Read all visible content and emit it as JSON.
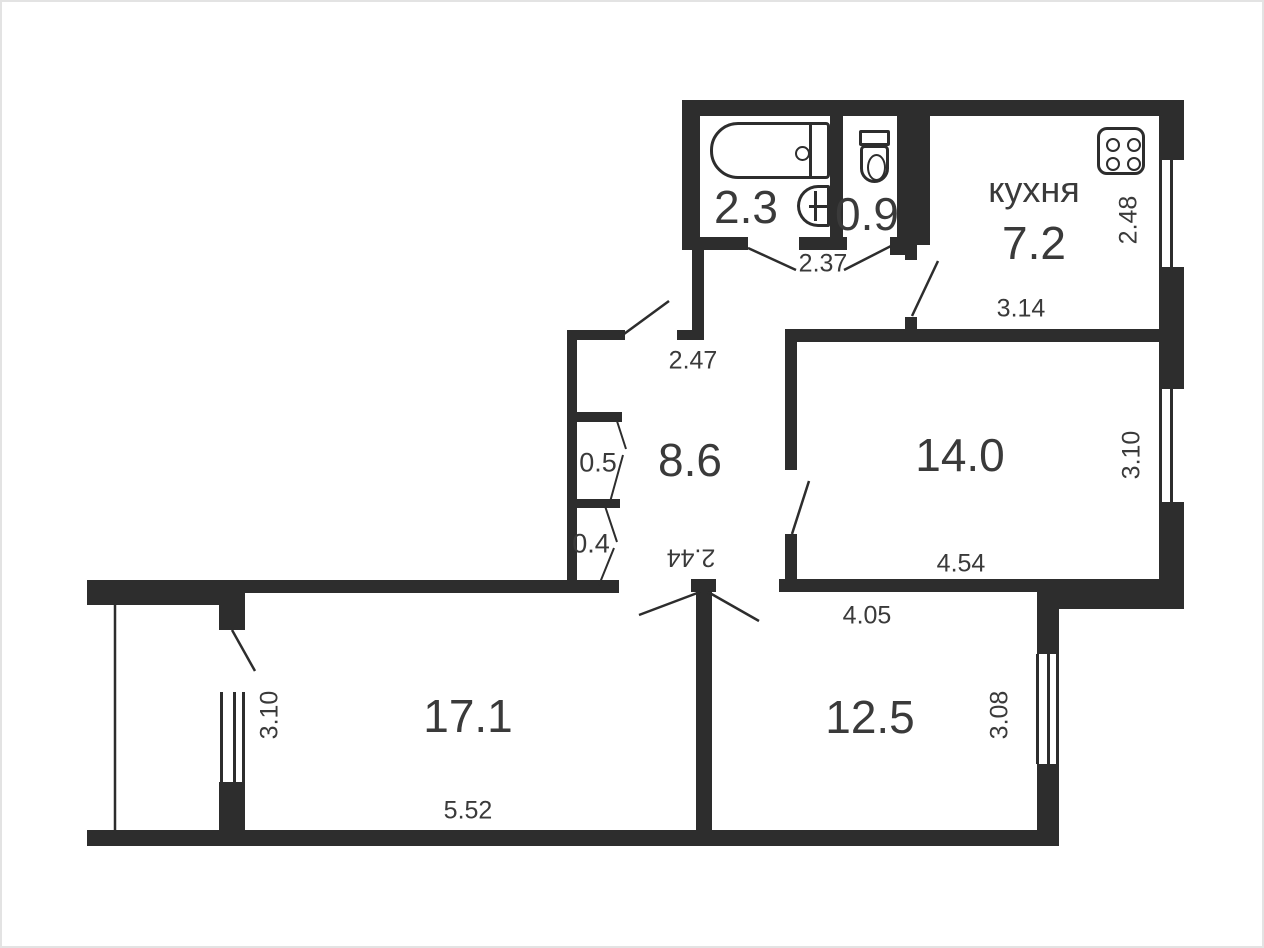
{
  "title": "apartment-floor-plan",
  "colors": {
    "wall": "#2d2d2d",
    "text": "#3a3a3a",
    "background": "#ffffff"
  },
  "labels": {
    "bathroom_area": "2.3",
    "wc_area": "0.9",
    "kitchen_name": "кухня",
    "kitchen_area": "7.2",
    "hall_area": "8.6",
    "closet_top_area": "0.5",
    "closet_bottom_area": "0.4",
    "room_large_area": "17.1",
    "room_medium_area": "14.0",
    "room_small_area": "12.5"
  },
  "dimensions": {
    "bath_block_width": "2.37",
    "kitchen_depth": "2.48",
    "kitchen_width": "3.14",
    "hall_top_width": "2.47",
    "hall_bottom_width": "2.44",
    "room_medium_width": "4.54",
    "room_medium_depth": "3.10",
    "room_small_width": "4.05",
    "room_small_depth": "3.08",
    "room_large_width": "5.52",
    "room_large_depth": "3.10"
  },
  "icons": [
    "bathtub-icon",
    "sink-icon",
    "toilet-icon",
    "stove-icon"
  ]
}
